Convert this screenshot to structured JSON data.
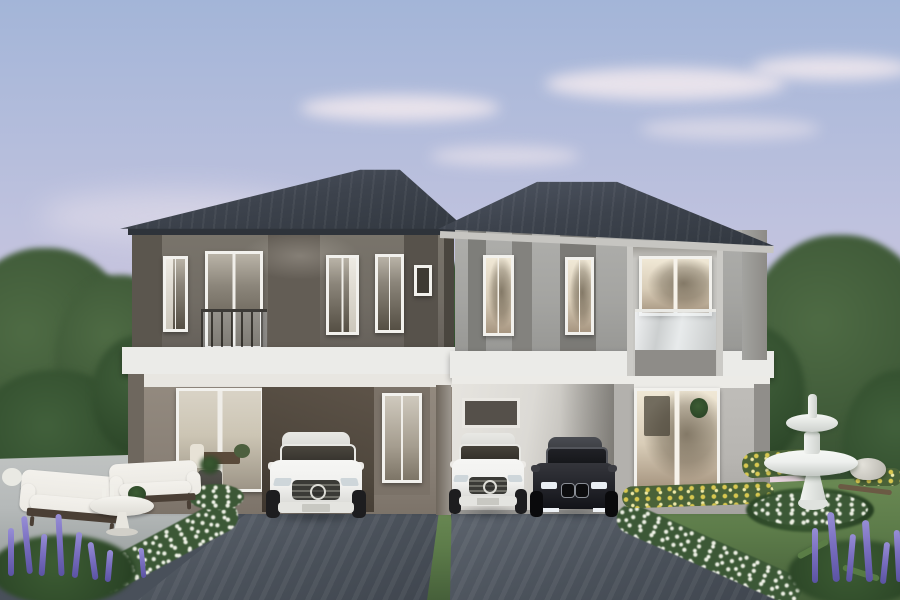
{
  "scene": {
    "type": "3D architectural exterior rendering",
    "subject": "Twin two-storey duplex houses with hipped dark-slate roofs at pastel dusk",
    "sky": "soft blue fading to pink with wispy clouds",
    "houses": [
      {
        "id": "left-house",
        "facade": "warm grey walls with dark taupe pilasters",
        "features": [
          "french balcony window",
          "three upper windows",
          "white floor slab band",
          "glass sliding patio door",
          "single dark carport",
          "white entry door"
        ]
      },
      {
        "id": "right-house",
        "facade": "light grey walls with dark vertical stripe panels",
        "features": [
          "large recessed picture window with glass balustrade",
          "two warm lit upper windows",
          "white floor slab band",
          "double carport",
          "glass entry door"
        ]
      }
    ],
    "vehicles": [
      {
        "id": "white-suv-left",
        "type": "white luxury SUV",
        "location": "left driveway under carport"
      },
      {
        "id": "white-suv-right",
        "type": "white compact SUV",
        "location": "right carport left bay"
      },
      {
        "id": "black-sedan",
        "type": "black luxury sedan",
        "location": "right carport right bay"
      }
    ],
    "garden": [
      "white two-tier garden fountain ringed by white flowers",
      "white outdoor sofa set with round pedestal table on stone patio",
      "diagonal white flower hedges",
      "purple flower spikes in both foreground corners",
      "yellow flower beds on right lawn",
      "mature green trees framing both sides",
      "white rock and fallen branch on lawn",
      "two dark asphalt driveways divided by a grass strip"
    ]
  },
  "palette": {
    "sky_top": "#a3b5d8",
    "sky_mid": "#bfc2de",
    "sky_horizon": "#e8d3dc",
    "cloud": "#f7edf0",
    "roof": "#3d434d",
    "roof_light": "#4f5663",
    "left_wall_upper": "#716c64",
    "left_wall_pilaster": "#5b564e",
    "left_wall_ground": "#8a8177",
    "left_carport": "#4f473d",
    "right_wall_upper": "#a4a4a1",
    "right_wall_stripe": "#7e7e7a",
    "right_wall_ground": "#b7b5b1",
    "right_carport": "#dcdad5",
    "slab": "#ebebe8",
    "frame": "#f2f1ed",
    "glass_dark": "#3e3a33",
    "glass_warm": "#d9cdb8",
    "driveway": "#4a515a",
    "driveway_light": "#5d646e",
    "lawn": "#5d7c4a",
    "lawn_shadow": "#46603a",
    "tree": "#4e6b44",
    "tree_dark": "#3a5434",
    "hedge_flower": "#edf0e4",
    "flower_purple": "#7a6fc0",
    "flower_yellow": "#d9c850",
    "fountain": "#eef0ee",
    "patio": "#b5b9b9",
    "sofa": "#eceae4",
    "wood": "#4a3f35",
    "car_white": "#f0f0ee",
    "car_black": "#24252b"
  }
}
